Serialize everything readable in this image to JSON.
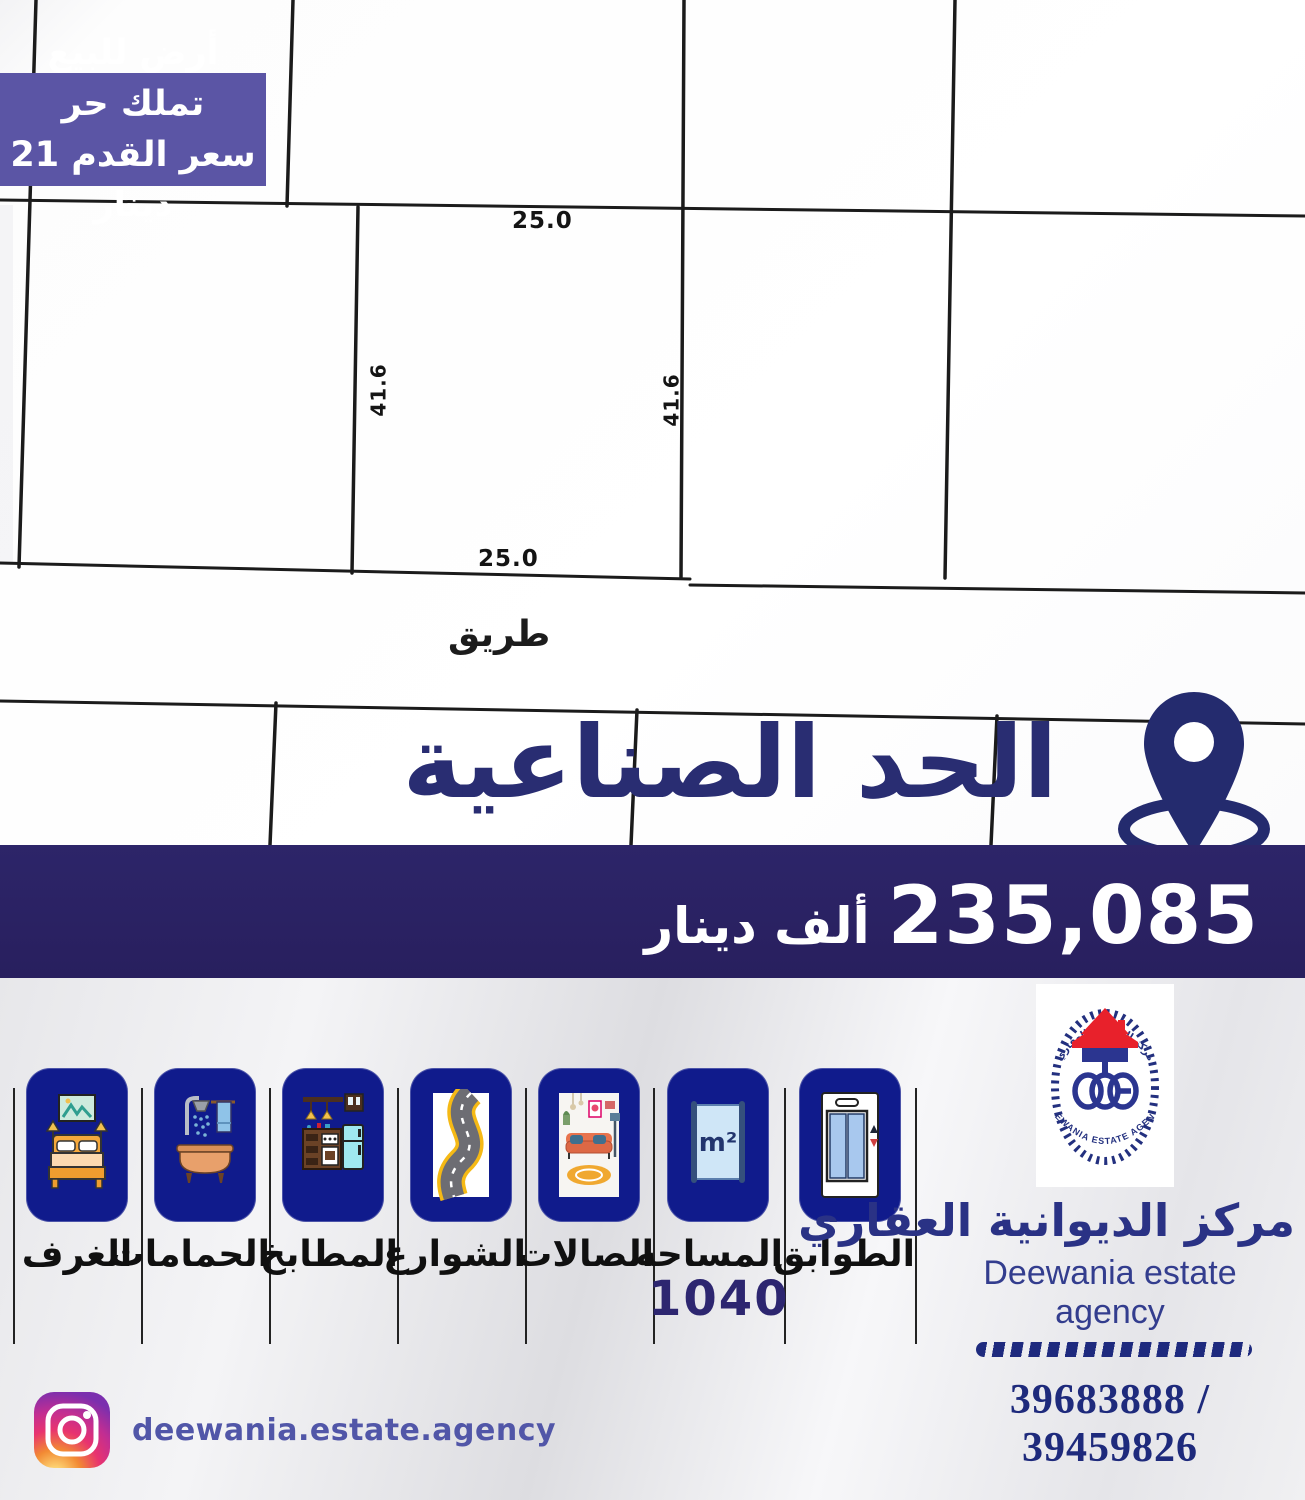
{
  "badge": {
    "line1": "أرض للبيع تملك حر",
    "line2": "سعر القدم 21 دينار"
  },
  "plot_map": {
    "top_width": "25.0",
    "bottom_width": "25.0",
    "left_depth": "41.6",
    "right_depth": "41.6",
    "road": "طريق"
  },
  "location": {
    "name": "الحد الصناعية",
    "icon": "location-pin-icon"
  },
  "price": {
    "amount": "235,085",
    "unit": "ألف دينار"
  },
  "features": [
    {
      "label": "الغرف",
      "icon": "bedroom-icon",
      "value": ""
    },
    {
      "label": "الحمامات",
      "icon": "bathroom-icon",
      "value": ""
    },
    {
      "label": "المطابخ",
      "icon": "kitchen-icon",
      "value": ""
    },
    {
      "label": "الشوارع",
      "icon": "road-icon",
      "value": ""
    },
    {
      "label": "الصالات",
      "icon": "living-room-icon",
      "value": ""
    },
    {
      "label": "المساحه",
      "icon": "area-m2-icon",
      "value": "1040",
      "unit_symbol": "m²"
    },
    {
      "label": "الطوابق",
      "icon": "elevator-icon",
      "value": ""
    }
  ],
  "agency": {
    "name_ar": "مركز الديوانية العقاري",
    "name_en": "Deewania estate agency",
    "logo_icon": "deewania-estate-agency-logo",
    "logo_arc_top": "مركز الديوانية العقاري",
    "logo_arc_bottom": "DEEWANIA ESTATE AGENCY",
    "phones": "39683888 / 39459826"
  },
  "social": {
    "platform_icon": "instagram-icon",
    "handle": "deewania.estate.agency"
  },
  "colors": {
    "badge_purple": "#5b55a5",
    "price_band_navy": "#281f5e",
    "heading_navy": "#292d72",
    "tile_blue": "#101b8c",
    "logo_red": "#e8212b",
    "logo_navy": "#2b3590"
  }
}
